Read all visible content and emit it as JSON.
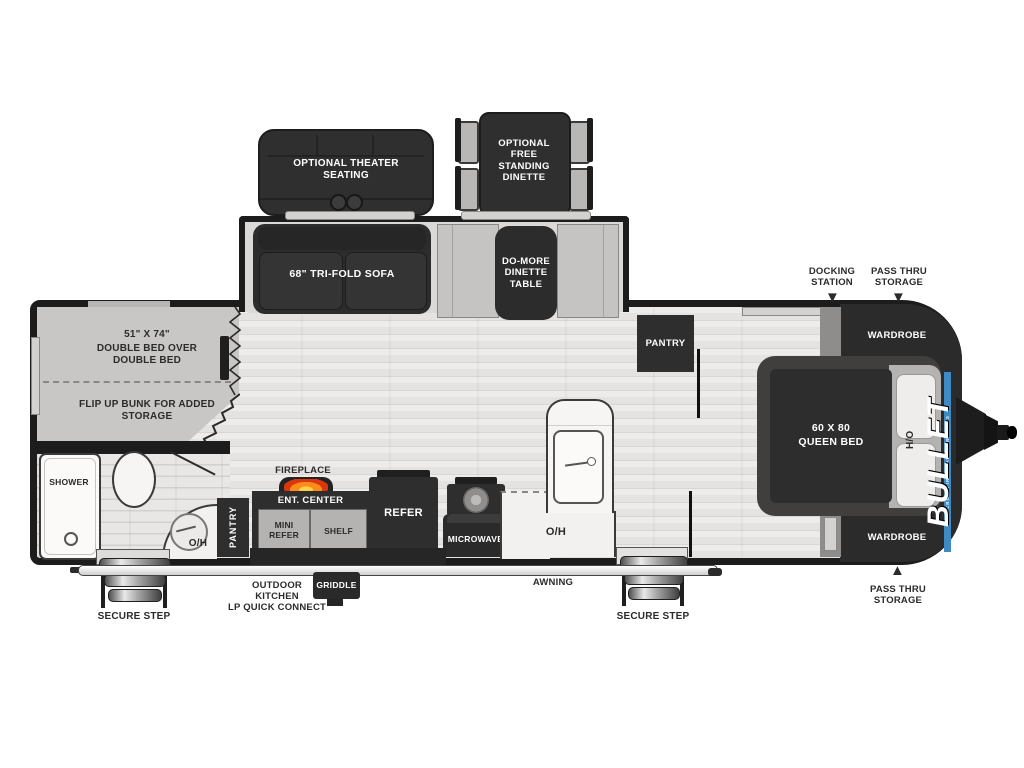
{
  "meta": {
    "title": "Keystone Bullet travel trailer floor plan"
  },
  "options": {
    "theater_seating": "OPTIONAL THEATER SEATING",
    "free_standing_dinette": "OPTIONAL FREE STANDING DINETTE"
  },
  "slideout": {
    "sofa": "68\" TRI-FOLD SOFA",
    "dinette_table": "DO-MORE DINETTE TABLE"
  },
  "bunk": {
    "size": "51\" X 74\"",
    "title": "DOUBLE BED OVER DOUBLE BED",
    "note": "FLIP UP BUNK FOR ADDED STORAGE"
  },
  "bath": {
    "shower": "SHOWER",
    "overhead": "O/H",
    "pantry": "PANTRY"
  },
  "kitchen": {
    "fireplace": "FIREPLACE",
    "ent_center": "ENT. CENTER",
    "mini_refer": "MINI REFER",
    "shelf": "SHELF",
    "refer": "REFER",
    "microwave": "MICROWAVE",
    "overhead": "O/H"
  },
  "bedroom": {
    "pantry": "PANTRY",
    "bed_line1": "60 X 80",
    "bed_line2": "QUEEN BED",
    "hamper": "H/O",
    "wardrobe_top": "WARDROBE",
    "wardrobe_bottom": "WARDROBE"
  },
  "exterior": {
    "docking_station": "DOCKING STATION",
    "pass_thru_top": "PASS THRU STORAGE",
    "pass_thru_bottom": "PASS THRU STORAGE",
    "awning": "AWNING",
    "griddle": "GRIDDLE",
    "outdoor_kitchen_line1": "OUTDOOR",
    "outdoor_kitchen_line2": "KITCHEN",
    "outdoor_kitchen_line3": "LP QUICK CONNECT",
    "secure_step_left": "SECURE STEP",
    "secure_step_right": "SECURE STEP",
    "brand": "BULLET",
    "brand_tagline": "CROSSFIRE TRAVEL TRAILERS"
  },
  "icons": {
    "pointer_down": "▼",
    "pointer_up": "▲"
  },
  "colors": {
    "outline": "#1c1c1c",
    "dark_furniture": "#2e2e2e",
    "floor": "#e5e3e1",
    "accent_blue": "#3d8ac4",
    "flame_orange": "#ff8c1a"
  }
}
